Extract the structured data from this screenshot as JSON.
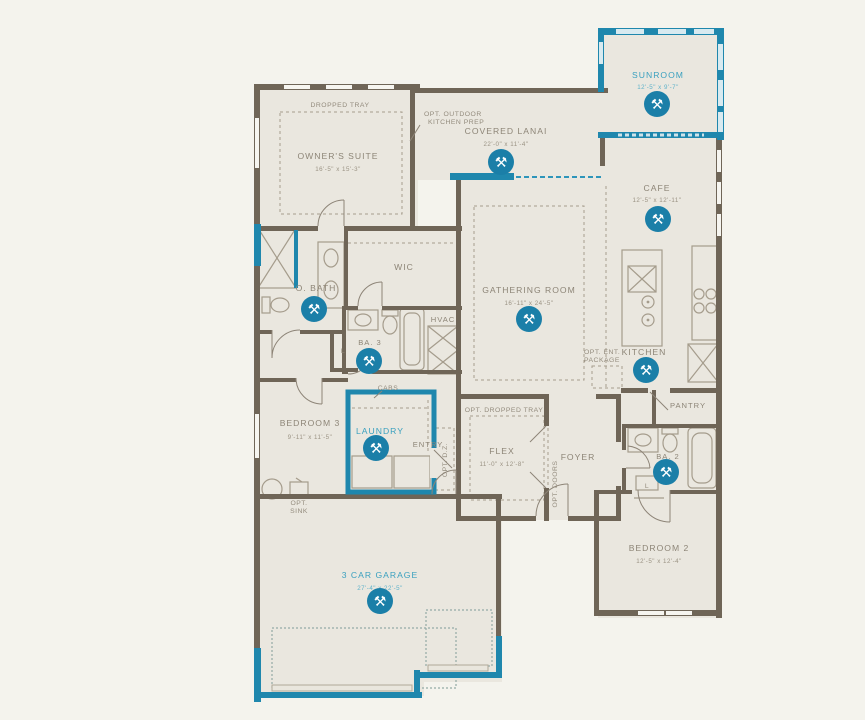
{
  "plan": {
    "rooms": {
      "sunroom": {
        "label": "SUNROOM",
        "dims": "12'-5\" x 9'-7\"",
        "highlight": true
      },
      "owners_suite": {
        "label": "OWNER'S SUITE",
        "dims": "16'-5\" x 15'-3\"",
        "highlight": false
      },
      "covered_lanai": {
        "label": "COVERED LANAI",
        "dims": "22'-0\" x 11'-4\"",
        "highlight": false
      },
      "cafe": {
        "label": "CAFE",
        "dims": "12'-5\" x 12'-11\"",
        "highlight": false
      },
      "gathering_room": {
        "label": "GATHERING ROOM",
        "dims": "16'-11\" x 24'-5\"",
        "highlight": false
      },
      "kitchen": {
        "label": "KITCHEN",
        "highlight": false
      },
      "pantry": {
        "label": "PANTRY",
        "highlight": false
      },
      "wic": {
        "label": "WIC",
        "highlight": false
      },
      "owners_bath": {
        "label": "O. BATH",
        "highlight": false
      },
      "bath_3": {
        "label": "BA. 3",
        "highlight": false
      },
      "hvac": {
        "label": "HVAC",
        "highlight": false
      },
      "bedroom_3": {
        "label": "BEDROOM 3",
        "dims": "9'-11\" x 11'-5\"",
        "highlight": false
      },
      "laundry": {
        "label": "LAUNDRY",
        "highlight": true
      },
      "entry": {
        "label": "ENTRY",
        "highlight": false
      },
      "flex": {
        "label": "FLEX",
        "dims": "11'-0\" x 12'-8\"",
        "highlight": false
      },
      "foyer": {
        "label": "FOYER",
        "highlight": false
      },
      "bath_2": {
        "label": "BA. 2",
        "highlight": false
      },
      "bedroom_2": {
        "label": "BEDROOM 2",
        "dims": "12'-5\" x 12'-4\"",
        "highlight": false
      },
      "garage": {
        "label": "3 CAR GARAGE",
        "dims": "27'-4\" x 22'-5\"",
        "highlight": true
      }
    },
    "annotations": {
      "dropped_tray": "DROPPED TRAY",
      "opt_outdoor_kitchen_1": "OPT. OUTDOOR",
      "opt_outdoor_kitchen_2": "KITCHEN PREP",
      "opt_ent_1": "OPT. ENT.",
      "opt_ent_2": "PACKAGE",
      "cabs": "CABS",
      "opt_dropped_tray": "OPT. DROPPED TRAY",
      "opt_dz": "OPT. D.Z.",
      "opt_doors": "OPT. DOORS",
      "opt_sink_1": "OPT.",
      "opt_sink_2": "SINK",
      "linen": "L"
    },
    "icons": {
      "tools_glyph": "⚒"
    },
    "palette": {
      "accent_teal": "#1f87ad",
      "wall_brown": "#6f6557",
      "room_fill": "#eae7df",
      "background": "#f4f3ed",
      "label_gray": "#8d8577",
      "label_teal": "#3aa0bf"
    }
  }
}
